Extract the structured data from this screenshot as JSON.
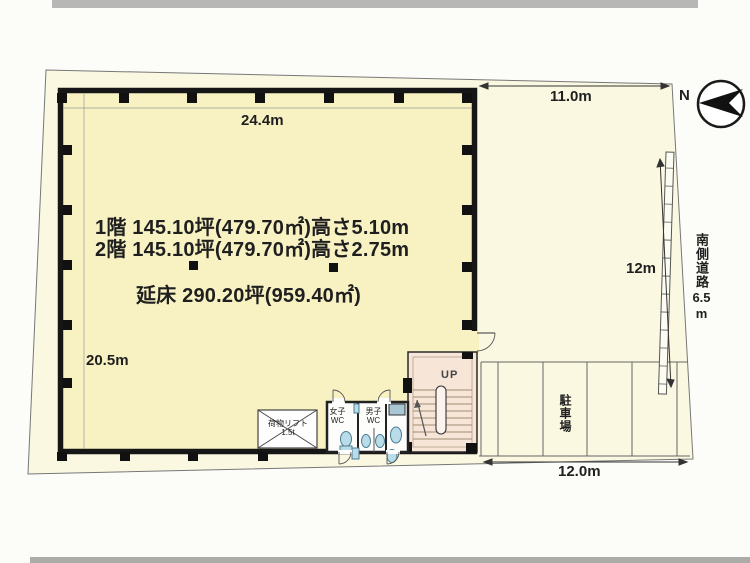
{
  "colors": {
    "background": "#fcfcf9",
    "site_fill": "#fbf8e2",
    "building_fill": "#f8f2c3",
    "stair_fill": "#f7e5d8",
    "fixture_blue": "#b9dce8",
    "wall": "#1a1a1a",
    "photo_edge": "#a9a9a9"
  },
  "compass": {
    "north_label": "N"
  },
  "building_text": {
    "floor1": "1階 145.10坪(479.70㎡)高さ5.10m",
    "floor2": "2階 145.10坪(479.70㎡)高さ2.75m",
    "total": "延床 290.20坪(959.40㎡)"
  },
  "dimensions": {
    "building_width": "24.4m",
    "building_depth": "20.5m",
    "yard_top": "11.0m",
    "yard_bottom": "12.0m",
    "road_frontage": "12m",
    "road_name": "南側道路",
    "road_width_value": "6.5",
    "road_width_unit": "m"
  },
  "labels": {
    "parking": "駐車場",
    "stairs_up": "UP",
    "cargo_lift": "荷物リフト",
    "cargo_lift_capacity": "1.5t",
    "wc_women": "女子WC",
    "wc_men": "男子WC"
  }
}
